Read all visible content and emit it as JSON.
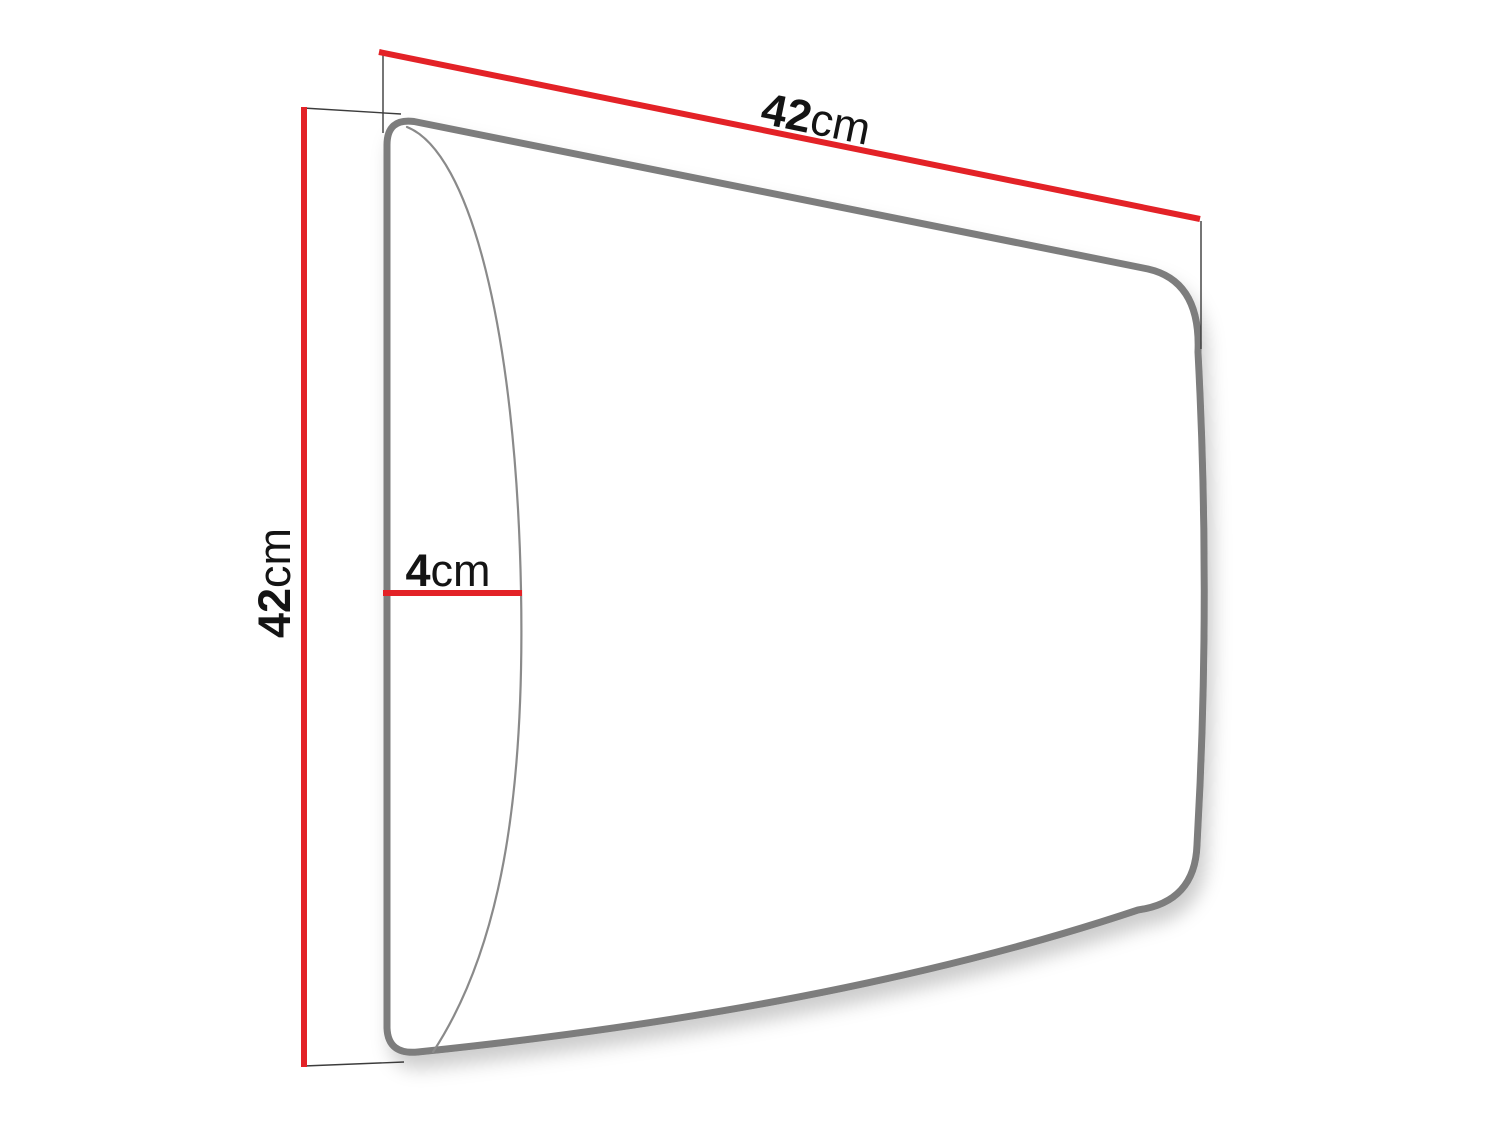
{
  "diagram": {
    "dimensions": {
      "width": {
        "value": "42",
        "unit": "cm"
      },
      "height": {
        "value": "42",
        "unit": "cm"
      },
      "depth": {
        "value": "4",
        "unit": "cm"
      }
    },
    "colors": {
      "dimension_line": "#e32227",
      "panel_outline": "#7d7d7d",
      "panel_side_line": "#8a8a8a",
      "extension_line": "#3c3c3c",
      "label_text": "#141414",
      "background": "#ffffff"
    }
  }
}
